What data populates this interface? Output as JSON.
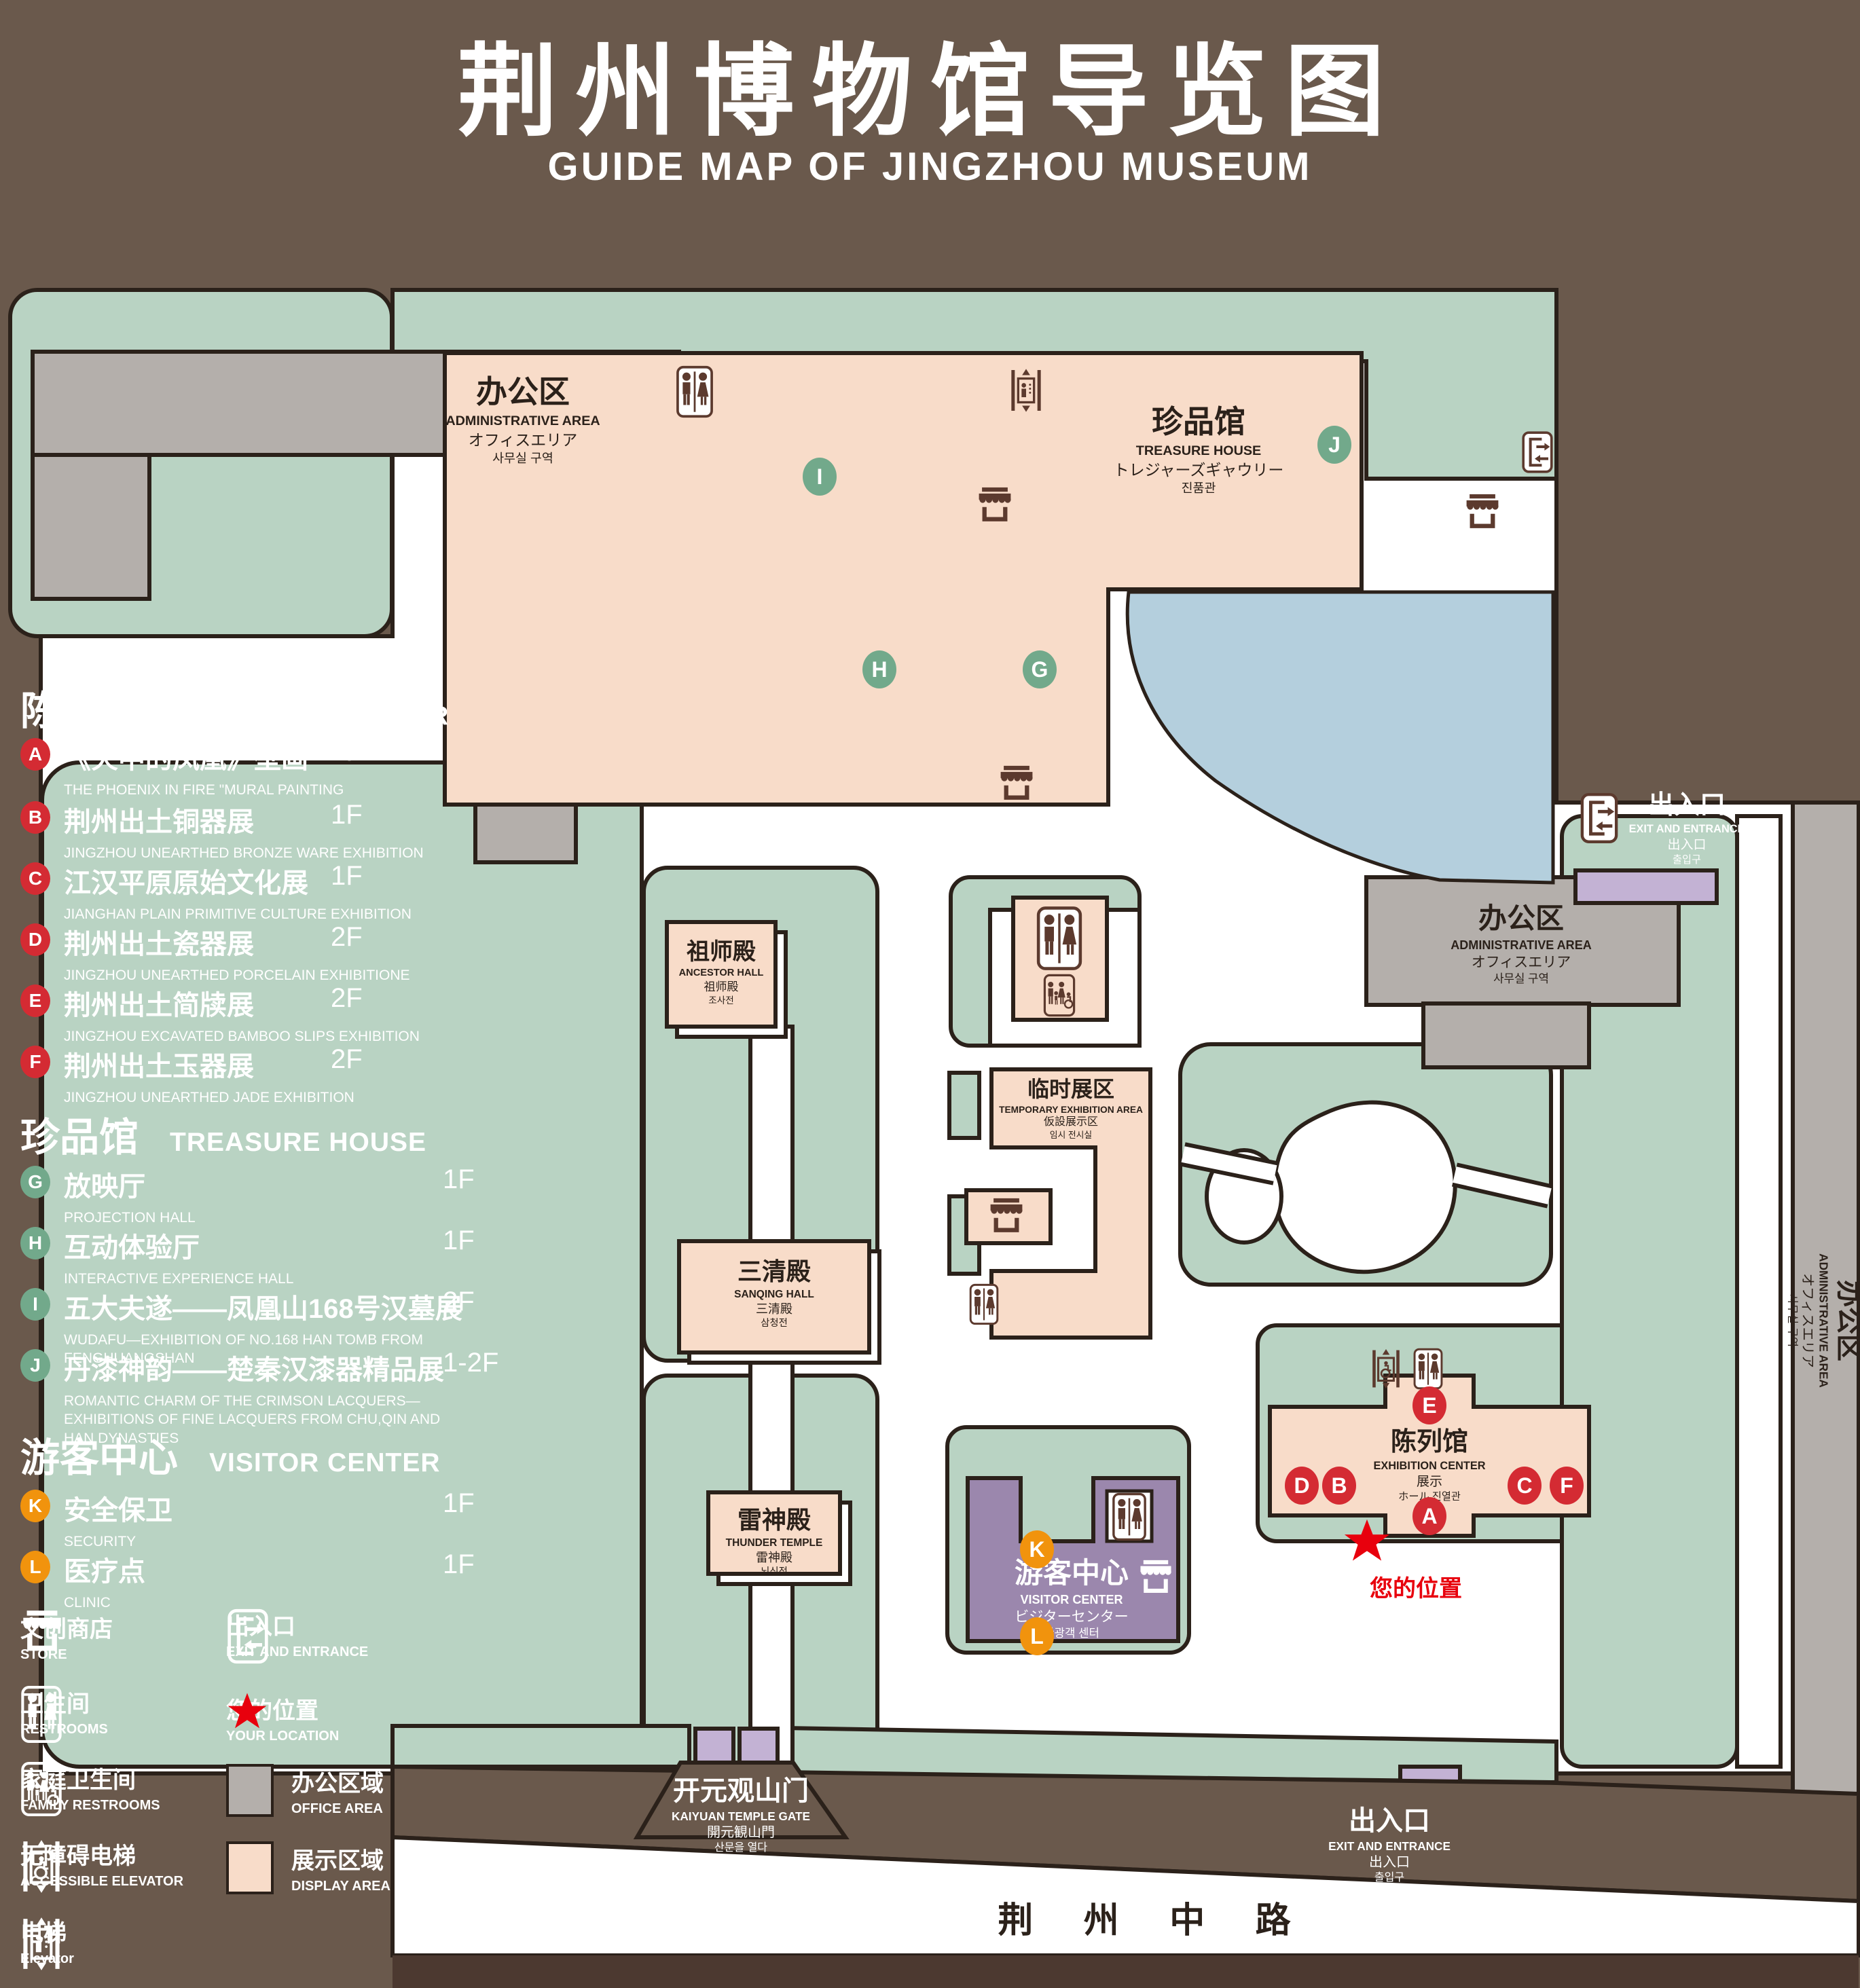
{
  "title": {
    "zh": "荆州博物馆导览图",
    "en": "GUIDE MAP OF JINGZHOU MUSEUM"
  },
  "colors": {
    "background": "#6a594c",
    "lawn_green": "#b9d3c3",
    "display_pink": "#f8dcc9",
    "office_gray": "#b4afab",
    "pond_blue": "#b4cfdd",
    "visitor_purple": "#9b87ad",
    "lavender": "#c3b2d4",
    "outline": "#2b211a",
    "icon_brown": "#5c3a2e",
    "badge_red": "#d42b33",
    "badge_green": "#72a98b",
    "badge_orange": "#f1930d",
    "location_red": "#e8000d",
    "road_band": "#4c3930"
  },
  "legend": {
    "sections": [
      {
        "zh": "陈列馆",
        "en": "EXHIBITION CENTER",
        "items": [
          {
            "letter": "A",
            "title": "《火中的凤凰》壁画",
            "subtitle": "THE PHOENIX IN FIRE \"MURAL PAINTING",
            "floor": "1F"
          },
          {
            "letter": "B",
            "title": "荆州出土铜器展",
            "subtitle": "JINGZHOU UNEARTHED BRONZE WARE EXHIBITION",
            "floor": "1F"
          },
          {
            "letter": "C",
            "title": "江汉平原原始文化展",
            "subtitle": "JIANGHAN PLAIN PRIMITIVE CULTURE EXHIBITION",
            "floor": "1F"
          },
          {
            "letter": "D",
            "title": "荆州出土瓷器展",
            "subtitle": "JINGZHOU UNEARTHED PORCELAIN EXHIBITIONE",
            "floor": "2F"
          },
          {
            "letter": "E",
            "title": "荆州出土简牍展",
            "subtitle": "JINGZHOU EXCAVATED BAMBOO SLIPS EXHIBITION",
            "floor": "2F"
          },
          {
            "letter": "F",
            "title": "荆州出土玉器展",
            "subtitle": "JINGZHOU UNEARTHED JADE EXHIBITION",
            "floor": "2F"
          }
        ]
      },
      {
        "zh": "珍品馆",
        "en": "TREASURE HOUSE",
        "items": [
          {
            "letter": "G",
            "title": "放映厅",
            "subtitle": "PROJECTION HALL",
            "floor": "1F"
          },
          {
            "letter": "H",
            "title": "互动体验厅",
            "subtitle": "INTERACTIVE EXPERIENCE HALL",
            "floor": "1F"
          },
          {
            "letter": "I",
            "title": "五大夫遂——凤凰山168号汉墓展",
            "subtitle": "WUDAFU—EXHIBITION OF NO.168 HAN TOMB FROM FENGHUANGSHAN",
            "floor": "2F"
          },
          {
            "letter": "J",
            "title": "丹漆神韵——楚秦汉漆器精品展",
            "subtitle": "ROMANTIC CHARM OF THE CRIMSON LACQUERS—EXHIBITIONS OF FINE LACQUERS FROM CHU,QIN AND HAN DYNASTIES",
            "floor": "1-2F"
          }
        ]
      },
      {
        "zh": "游客中心",
        "en": "VISITOR CENTER",
        "items": [
          {
            "letter": "K",
            "title": "安全保卫",
            "subtitle": "SECURITY",
            "floor": "1F"
          },
          {
            "letter": "L",
            "title": "医疗点",
            "subtitle": "CLINIC",
            "floor": "1F"
          }
        ]
      }
    ],
    "symbols": [
      {
        "icon": "store-icon",
        "zh": "文创商店",
        "en": "STORE"
      },
      {
        "icon": "exit-icon",
        "zh": "出入口",
        "en": "EXIT AND ENTRANCE"
      },
      {
        "icon": "restroom-icon",
        "zh": "卫生间",
        "en": "RESTROOMS"
      },
      {
        "icon": "location-star-icon",
        "zh": "您的位置",
        "en": "YOUR LOCATION"
      },
      {
        "icon": "family-restroom-icon",
        "zh": "家庭卫生间",
        "en": "FAMILY RESTROOMS"
      },
      {
        "icon": "office-area-swatch",
        "zh": "办公区域",
        "en": "OFFICE AREA"
      },
      {
        "icon": "accessible-elevator-icon",
        "zh": "无障碍电梯",
        "en": "ACCESSIBLE ELEVATOR"
      },
      {
        "icon": "display-area-swatch",
        "zh": "展示区域",
        "en": "DISPLAY AREA"
      },
      {
        "icon": "elevator-icon",
        "zh": "电梯",
        "en": "Elevator"
      }
    ]
  },
  "map": {
    "admin_nw": {
      "zh": "办公区",
      "en": "ADMINISTRATIVE AREA",
      "ja": "オフィスエリア",
      "ko": "사무실 구역"
    },
    "admin_e": {
      "zh": "办公区",
      "en": "ADMINISTRATIVE AREA",
      "ja": "オフィスエリア",
      "ko": "사무실 구역"
    },
    "admin_strip": {
      "zh": "办公区",
      "en": "ADMINISTRATIVE AREA",
      "ja": "オフィスエリア",
      "ko": "사무실 구역"
    },
    "treasure": {
      "zh": "珍品馆",
      "en": "TREASURE HOUSE",
      "ja": "トレジャーズギャウリー",
      "ko": "진품관"
    },
    "ancestor": {
      "zh": "祖师殿",
      "en": "ANCESTOR HALL",
      "ja": "祖师殿",
      "ko": "조사전"
    },
    "sanqing": {
      "zh": "三清殿",
      "en": "SANQING HALL",
      "ja": "三清殿",
      "ko": "삼청전"
    },
    "thunder": {
      "zh": "雷神殿",
      "en": "THUNDER TEMPLE",
      "ja": "雷神殿",
      "ko": "뇌신전"
    },
    "temporary": {
      "zh": "临时展区",
      "en": "TEMPORARY EXHIBITION AREA",
      "ja": "仮設展示区",
      "ko": "임시 전시실"
    },
    "visitor": {
      "zh": "游客中心",
      "en": "VISITOR CENTER",
      "ja": "ビジターセンター",
      "ko": "관광객 센터"
    },
    "exhibition": {
      "zh": "陈列馆",
      "en": "EXHIBITION CENTER",
      "ja": "展示",
      "ko": "ホール 진열관"
    },
    "gate": {
      "zh": "开元观山门",
      "en": "KAIYUAN TEMPLE GATE",
      "ja": "開元観山門",
      "ko": "산문을 열다"
    },
    "exit_ne": {
      "zh": "出入口",
      "en": "EXIT AND ENTRANCE",
      "ja": "出入口",
      "ko": "출입구"
    },
    "exit_s": {
      "zh": "出入口",
      "en": "EXIT AND ENTRANCE",
      "ja": "出入口",
      "ko": "출입구"
    },
    "your_location": "您的位置",
    "road": "荆 州 中 路"
  }
}
